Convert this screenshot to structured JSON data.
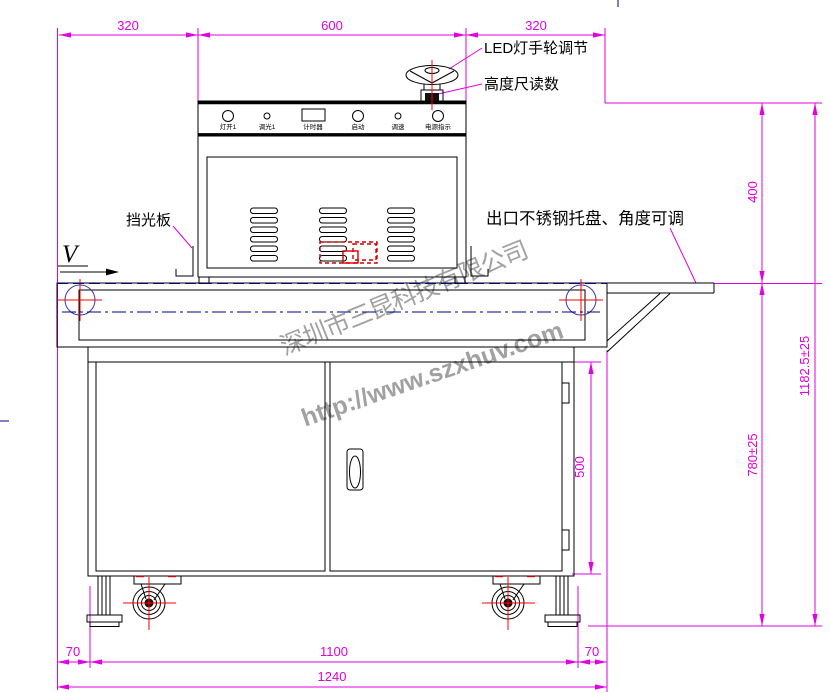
{
  "dimensions": {
    "top_left": "320",
    "top_center": "600",
    "top_right": "320",
    "lamp_height": "400",
    "total_height": "1182.5±25",
    "table_height": "780±25",
    "door_height": "500",
    "bottom_left": "70",
    "bottom_center": "1100",
    "bottom_right": "70",
    "total_width": "1240"
  },
  "annotations": {
    "led_handwheel": "LED灯手轮调节",
    "height_scale": "高度尺读数",
    "light_shield": "挡光板",
    "exit_tray": "出口不锈钢托盘、角度可调",
    "belt_direction": "V"
  },
  "control_panel": {
    "controls": [
      {
        "label": "灯开1",
        "type": "round-button-large"
      },
      {
        "label": "调光1",
        "type": "knob-small"
      },
      {
        "label": "计时器",
        "type": "timer-display"
      },
      {
        "label": "启动",
        "type": "round-button-large"
      },
      {
        "label": "调速",
        "type": "knob-small"
      },
      {
        "label": "电源指示",
        "type": "indicator-lamp"
      }
    ]
  },
  "watermark": {
    "company": "深圳市三昆科技有限公司",
    "website": "http://www.szxhuv.com"
  },
  "colors": {
    "dimension": "#e100e1",
    "line": "#000000",
    "centerline_red": "#ff0000",
    "centerline_navy": "#00008b",
    "watermark_gray": "#8a8a8a"
  }
}
